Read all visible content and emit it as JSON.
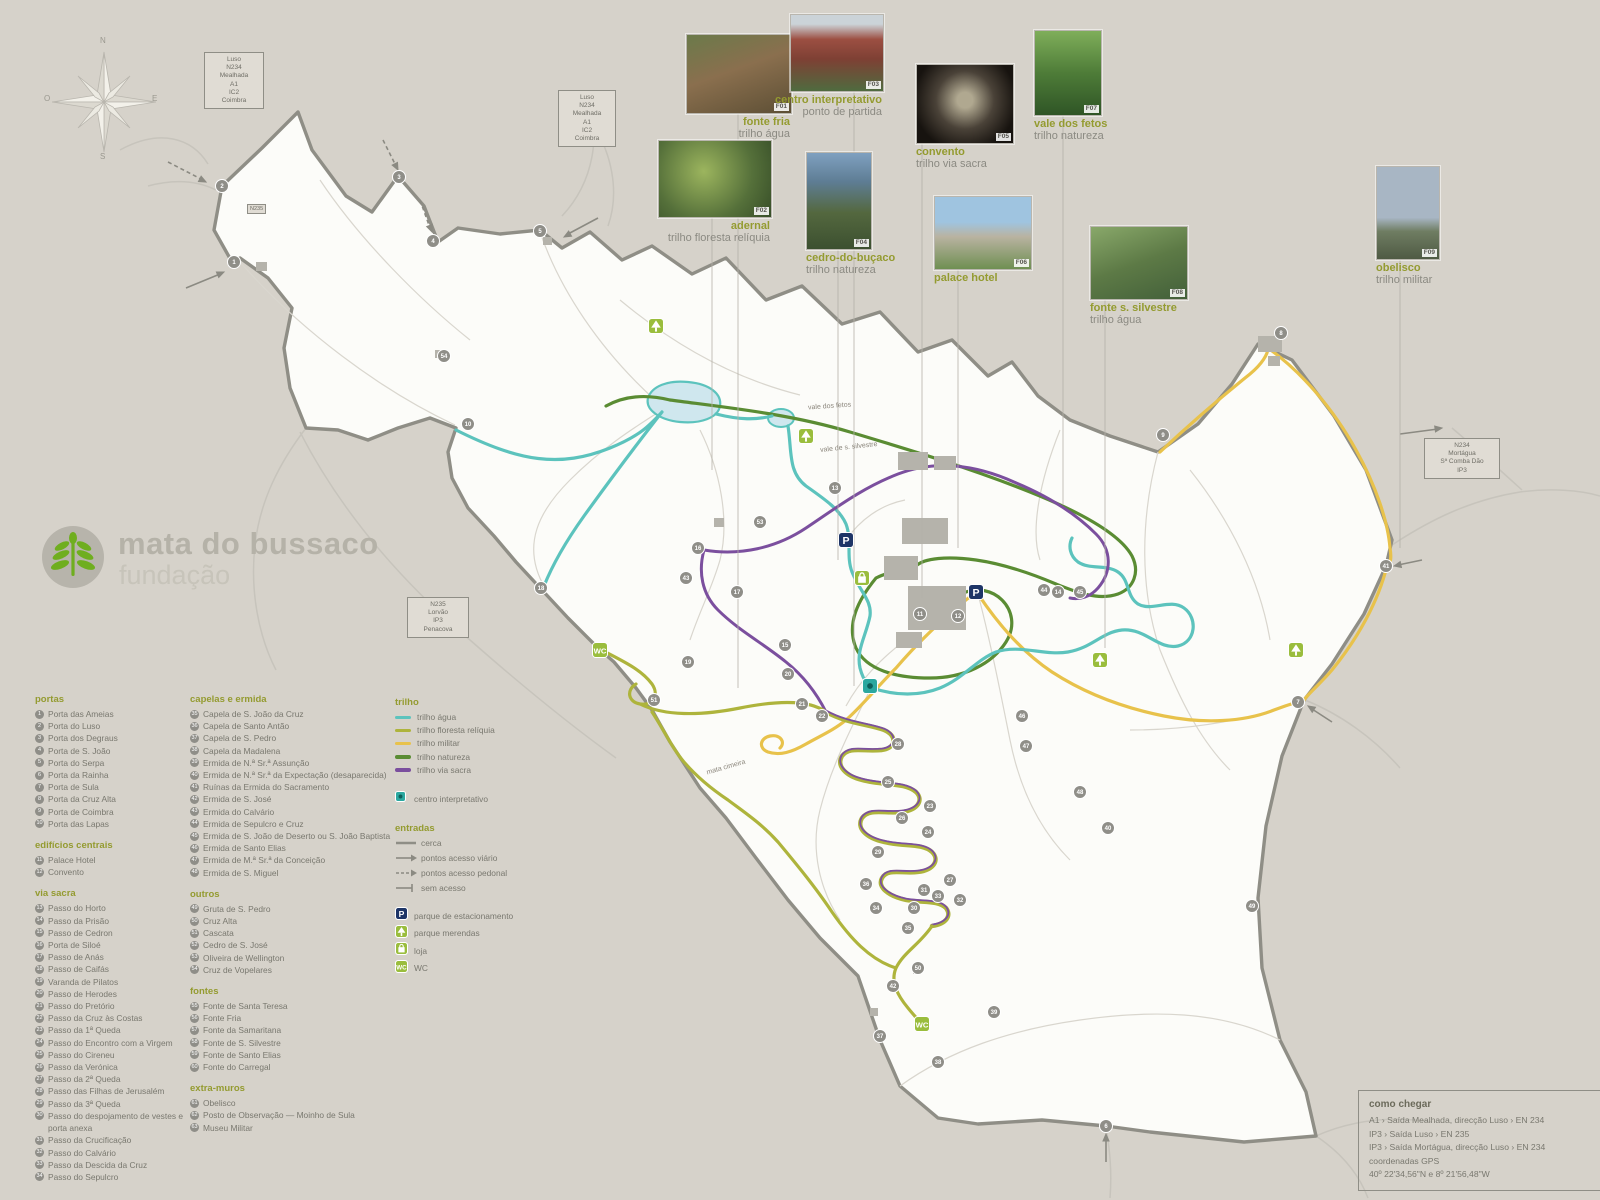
{
  "logo": {
    "title": "mata do bussaco",
    "subtitle": "fundação"
  },
  "compass": {
    "n": "N",
    "s": "S",
    "e": "E",
    "o": "O"
  },
  "colors": {
    "trail_agua": "#5cc3bd",
    "trail_floresta_reliquia": "#aeb43c",
    "trail_militar": "#e8c24b",
    "trail_natureza": "#5a8c33",
    "trail_via_sacra": "#7b4f9e",
    "parking": "#1e3567",
    "facility_green": "#9abd3d",
    "centro": "#2ba8a0",
    "marker": "#8f8e88",
    "boundary": "#8f8e86"
  },
  "photos": [
    {
      "tag": "F01",
      "name": "fonte fria",
      "trail": "trilho água"
    },
    {
      "tag": "F03",
      "name": "centro interpretativo",
      "trail": "ponto de partida"
    },
    {
      "tag": "F02",
      "name": "adernal",
      "trail": "trilho floresta relíquia"
    },
    {
      "tag": "F04",
      "name": "cedro-do-buçaco",
      "trail": "trilho natureza"
    },
    {
      "tag": "F05",
      "name": "convento",
      "trail": "trilho via sacra"
    },
    {
      "tag": "F07",
      "name": "vale dos fetos",
      "trail": "trilho natureza"
    },
    {
      "tag": "F06",
      "name": "palace hotel",
      "trail": ""
    },
    {
      "tag": "F08",
      "name": "fonte s. silvestre",
      "trail": "trilho água"
    },
    {
      "tag": "F09",
      "name": "obelisco",
      "trail": "trilho militar"
    }
  ],
  "legend": {
    "portas": {
      "title": "portas",
      "items": [
        {
          "n": 1,
          "label": "Porta das Ameias"
        },
        {
          "n": 2,
          "label": "Porta do Luso"
        },
        {
          "n": 3,
          "label": "Porta dos Degraus"
        },
        {
          "n": 4,
          "label": "Porta de S. João"
        },
        {
          "n": 5,
          "label": "Porta do Serpa"
        },
        {
          "n": 6,
          "label": "Porta da Rainha"
        },
        {
          "n": 7,
          "label": "Porta de Sula"
        },
        {
          "n": 8,
          "label": "Porta da Cruz Alta"
        },
        {
          "n": 9,
          "label": "Porta de Coimbra"
        },
        {
          "n": 10,
          "label": "Porta das Lapas"
        }
      ]
    },
    "edificios": {
      "title": "edifícios centrais",
      "items": [
        {
          "n": 11,
          "label": "Palace Hotel"
        },
        {
          "n": 12,
          "label": "Convento"
        }
      ]
    },
    "via_sacra": {
      "title": "via sacra",
      "items": [
        {
          "n": 13,
          "label": "Passo do Horto"
        },
        {
          "n": 14,
          "label": "Passo da Prisão"
        },
        {
          "n": 15,
          "label": "Passo de Cedron"
        },
        {
          "n": 16,
          "label": "Porta de Siloé"
        },
        {
          "n": 17,
          "label": "Passo de Anás"
        },
        {
          "n": 18,
          "label": "Passo de Caifás"
        },
        {
          "n": 19,
          "label": "Varanda de Pilatos"
        },
        {
          "n": 20,
          "label": "Passo de Herodes"
        },
        {
          "n": 21,
          "label": "Passo do Pretório"
        },
        {
          "n": 22,
          "label": "Passo da Cruz às Costas"
        },
        {
          "n": 23,
          "label": "Passo da 1ª Queda"
        },
        {
          "n": 24,
          "label": "Passo do Encontro com a Virgem"
        },
        {
          "n": 25,
          "label": "Passo  do Cireneu"
        },
        {
          "n": 26,
          "label": "Passo da Verónica"
        },
        {
          "n": 27,
          "label": "Passo da 2ª Queda"
        },
        {
          "n": 28,
          "label": "Passo das Filhas de Jerusalém"
        },
        {
          "n": 29,
          "label": "Passo da 3ª Queda"
        },
        {
          "n": 30,
          "label": "Passo do despojamento de vestes e porta anexa"
        },
        {
          "n": 31,
          "label": "Passo da Crucificação"
        },
        {
          "n": 32,
          "label": "Passo do Calvário"
        },
        {
          "n": 33,
          "label": "Passo da Descida da Cruz"
        },
        {
          "n": 34,
          "label": "Passo do Sepulcro"
        }
      ]
    },
    "capelas": {
      "title": "capelas e ermida",
      "items": [
        {
          "n": 35,
          "label": "Capela de S. João da Cruz"
        },
        {
          "n": 36,
          "label": "Capela de Santo Antão"
        },
        {
          "n": 37,
          "label": "Capela de S. Pedro"
        },
        {
          "n": 38,
          "label": "Capela da Madalena"
        },
        {
          "n": 39,
          "label": "Ermida de N.ª Sr.ª Assunção"
        },
        {
          "n": 40,
          "label": "Ermida de N.ª Sr.ª da Expectação (desaparecida)"
        },
        {
          "n": 41,
          "label": "Ruínas da Ermida do Sacramento"
        },
        {
          "n": 42,
          "label": "Ermida de S. José"
        },
        {
          "n": 43,
          "label": "Ermida do Calvário"
        },
        {
          "n": 44,
          "label": "Ermida de Sepulcro e Cruz"
        },
        {
          "n": 45,
          "label": "Ermida de S. João de Deserto ou S. João Baptista"
        },
        {
          "n": 46,
          "label": "Ermida de Santo Elias"
        },
        {
          "n": 47,
          "label": "Ermida de M.ª Sr.ª da Conceição"
        },
        {
          "n": 48,
          "label": "Ermida de S. Miguel"
        }
      ]
    },
    "outros": {
      "title": "outros",
      "items": [
        {
          "n": 49,
          "label": "Gruta de S. Pedro"
        },
        {
          "n": 50,
          "label": "Cruz Alta"
        },
        {
          "n": 51,
          "label": "Cascata"
        },
        {
          "n": 52,
          "label": "Cedro de S. José"
        },
        {
          "n": 53,
          "label": "Oliveira de Wellington"
        },
        {
          "n": 54,
          "label": "Cruz de Vopelares"
        }
      ]
    },
    "fontes": {
      "title": "fontes",
      "items": [
        {
          "n": 55,
          "label": "Fonte de Santa Teresa"
        },
        {
          "n": 56,
          "label": "Fonte Fria"
        },
        {
          "n": 57,
          "label": "Fonte da Samaritana"
        },
        {
          "n": 58,
          "label": "Fonte de S. Silvestre"
        },
        {
          "n": 59,
          "label": "Fonte de Santo Elias"
        },
        {
          "n": 60,
          "label": "Fonte do Carregal"
        }
      ]
    },
    "extra_muros": {
      "title": "extra-muros",
      "items": [
        {
          "n": 61,
          "label": "Obelisco"
        },
        {
          "n": 62,
          "label": "Posto de Observação — Moinho de Sula"
        },
        {
          "n": 63,
          "label": "Museu Militar"
        }
      ]
    },
    "trilho": {
      "title": "trilho",
      "items": [
        {
          "key": "agua",
          "label": "trilho água",
          "color": "#5cc3bd"
        },
        {
          "key": "floresta",
          "label": "trilho floresta relíquia",
          "color": "#aeb43c"
        },
        {
          "key": "militar",
          "label": "trilho militar",
          "color": "#e8c24b"
        },
        {
          "key": "natureza",
          "label": "trilho natureza",
          "color": "#5a8c33"
        },
        {
          "key": "viasacra",
          "label": "trilho via sacra",
          "color": "#7b4f9e"
        }
      ]
    },
    "centro_interpretativo": {
      "label": "centro interpretativo"
    },
    "entradas": {
      "title": "entradas",
      "items": [
        {
          "sym": "line",
          "label": "cerca"
        },
        {
          "sym": "arrow",
          "label": "pontos acesso viário"
        },
        {
          "sym": "dasharrow",
          "label": "pontos acesso pedonal"
        },
        {
          "sym": "noaccess",
          "label": "sem acesso"
        }
      ]
    },
    "facilities": {
      "items": [
        {
          "icon": "p",
          "label": "parque de estacionamento"
        },
        {
          "icon": "picnic",
          "label": "parque merendas"
        },
        {
          "icon": "shop",
          "label": "loja"
        },
        {
          "icon": "wc",
          "label": "WC"
        }
      ]
    }
  },
  "signs": [
    {
      "lines": [
        "Luso",
        "N234",
        "Mealhada",
        "A1",
        "IC2",
        "Coimbra"
      ]
    },
    {
      "lines": [
        "Luso",
        "N234",
        "Mealhada",
        "A1",
        "IC2",
        "Coimbra"
      ]
    },
    {
      "lines": [
        "N234",
        "Mortágua",
        "Sª Comba Dão",
        "IP3"
      ]
    },
    {
      "lines": [
        "N235",
        "Lorvão",
        "IP3",
        "Penacova"
      ]
    }
  ],
  "sign_tag": "N235",
  "como_chegar": {
    "title": "como chegar",
    "lines": [
      "A1 › Saída Mealhada, direcção Luso › EN 234",
      "IP3 › Saída Luso › EN 235",
      "IP3 › Saída Mortágua, direcção Luso › EN 234",
      "coordenadas GPS",
      "40º 22'34,56\"N e 8º 21'56,48\"W"
    ]
  },
  "map": {
    "labels": [
      {
        "text": "vale dos fetos",
        "x": 808,
        "y": 403,
        "rot": -4
      },
      {
        "text": "vale de s. silvestre",
        "x": 820,
        "y": 444,
        "rot": -6
      },
      {
        "text": "mata cimeira",
        "x": 706,
        "y": 764,
        "rot": -16
      }
    ],
    "markers": [
      [
        1,
        234,
        262
      ],
      [
        2,
        222,
        186
      ],
      [
        3,
        399,
        177
      ],
      [
        4,
        433,
        241
      ],
      [
        5,
        540,
        231
      ],
      [
        6,
        1106,
        1126
      ],
      [
        7,
        1298,
        702
      ],
      [
        8,
        1281,
        333
      ],
      [
        9,
        1163,
        435
      ],
      [
        10,
        468,
        424
      ],
      [
        18,
        541,
        588
      ],
      [
        41,
        1386,
        566
      ],
      [
        11,
        920,
        614
      ],
      [
        12,
        958,
        616
      ],
      [
        13,
        835,
        488
      ],
      [
        14,
        1058,
        592
      ],
      [
        15,
        785,
        645
      ],
      [
        16,
        698,
        548
      ],
      [
        17,
        737,
        592
      ],
      [
        19,
        688,
        662
      ],
      [
        20,
        788,
        674
      ],
      [
        21,
        802,
        704
      ],
      [
        22,
        822,
        716
      ],
      [
        23,
        930,
        806
      ],
      [
        24,
        928,
        832
      ],
      [
        25,
        888,
        782
      ],
      [
        26,
        902,
        818
      ],
      [
        27,
        950,
        880
      ],
      [
        28,
        898,
        744
      ],
      [
        29,
        878,
        852
      ],
      [
        30,
        914,
        908
      ],
      [
        31,
        924,
        890
      ],
      [
        32,
        960,
        900
      ],
      [
        33,
        938,
        896
      ],
      [
        34,
        876,
        908
      ],
      [
        35,
        908,
        928
      ],
      [
        36,
        866,
        884
      ],
      [
        37,
        880,
        1036
      ],
      [
        38,
        938,
        1062
      ],
      [
        39,
        994,
        1012
      ],
      [
        40,
        1108,
        828
      ],
      [
        42,
        893,
        986
      ],
      [
        43,
        686,
        578
      ],
      [
        44,
        1044,
        590
      ],
      [
        45,
        1080,
        592
      ],
      [
        46,
        1022,
        716
      ],
      [
        47,
        1026,
        746
      ],
      [
        48,
        1080,
        792
      ],
      [
        49,
        1252,
        906
      ],
      [
        50,
        918,
        968
      ],
      [
        51,
        654,
        700
      ],
      [
        53,
        760,
        522
      ],
      [
        54,
        444,
        356
      ]
    ],
    "facilities": [
      {
        "type": "p",
        "x": 846,
        "y": 540
      },
      {
        "type": "p",
        "x": 976,
        "y": 592
      },
      {
        "type": "picnic",
        "x": 806,
        "y": 436
      },
      {
        "type": "picnic",
        "x": 1100,
        "y": 660
      },
      {
        "type": "picnic",
        "x": 1296,
        "y": 650
      },
      {
        "type": "picnic",
        "x": 656,
        "y": 326
      },
      {
        "type": "shop",
        "x": 862,
        "y": 578
      },
      {
        "type": "wc",
        "x": 600,
        "y": 650
      },
      {
        "type": "wc",
        "x": 922,
        "y": 1024
      },
      {
        "type": "centro",
        "x": 870,
        "y": 686
      }
    ]
  }
}
